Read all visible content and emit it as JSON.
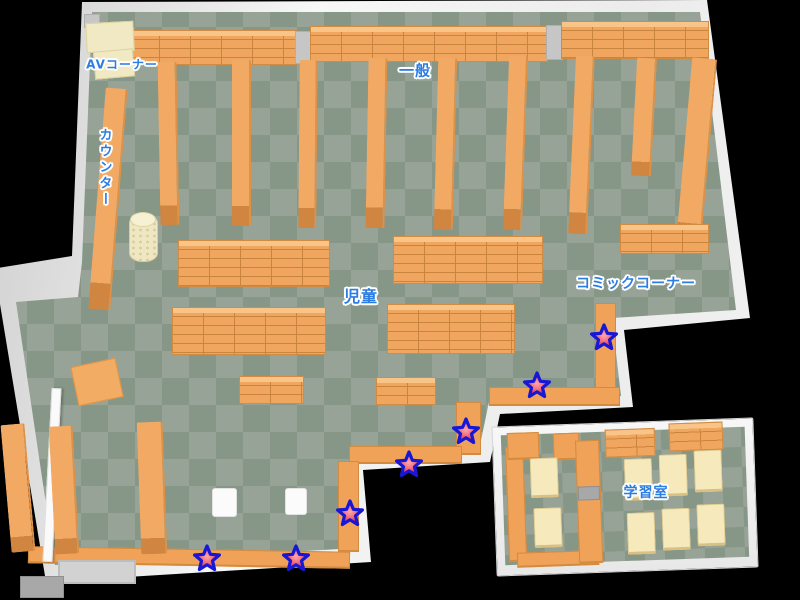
{
  "map": {
    "colors": {
      "background": "#000000",
      "floor_light": "#96a396",
      "floor_dark": "#879787",
      "wall": "#f2f2f2",
      "shelf_orange": "#f0a65f",
      "desk_cream": "#f6e9bb",
      "label_blue": "#2b7de2",
      "star_fill": "#e42f4d",
      "star_center": "#ffa8ac",
      "star_border": "#1717d6"
    },
    "labels": [
      {
        "id": "av-corner",
        "text": "AVコーナー",
        "x": 122,
        "y": 64,
        "size": 12,
        "vertical": false
      },
      {
        "id": "counter",
        "text": "カウンター",
        "x": 104,
        "y": 168,
        "size": 13,
        "vertical": true
      },
      {
        "id": "general",
        "text": "一般",
        "x": 415,
        "y": 70,
        "size": 15,
        "vertical": false
      },
      {
        "id": "children",
        "text": "児童",
        "x": 361,
        "y": 295,
        "size": 16,
        "vertical": false
      },
      {
        "id": "comic-corner",
        "text": "コミックコーナー",
        "x": 636,
        "y": 283,
        "size": 14,
        "vertical": false
      },
      {
        "id": "study-room",
        "text": "学習室",
        "x": 646,
        "y": 492,
        "size": 14,
        "vertical": false
      }
    ],
    "stars": [
      {
        "x": 604,
        "y": 337
      },
      {
        "x": 537,
        "y": 385
      },
      {
        "x": 466,
        "y": 431
      },
      {
        "x": 409,
        "y": 464
      },
      {
        "x": 350,
        "y": 513
      },
      {
        "x": 296,
        "y": 558
      },
      {
        "x": 207,
        "y": 558
      }
    ],
    "furniture": [
      {
        "t": "shelfgrid",
        "x": 128,
        "y": 30,
        "w": 167,
        "h": 33,
        "name": "wall-shelving"
      },
      {
        "t": "pillar",
        "x": 295,
        "y": 31,
        "w": 15,
        "h": 31,
        "name": "pillar"
      },
      {
        "t": "shelfgrid",
        "x": 310,
        "y": 26,
        "w": 236,
        "h": 34,
        "name": "wall-shelving"
      },
      {
        "t": "pillar",
        "x": 546,
        "y": 25,
        "w": 15,
        "h": 33,
        "name": "pillar"
      },
      {
        "t": "shelfgrid",
        "x": 561,
        "y": 21,
        "w": 146,
        "h": 36,
        "name": "wall-shelving"
      },
      {
        "t": "pillar",
        "x": 84,
        "y": 14,
        "w": 14,
        "h": 12,
        "name": "pillar"
      },
      {
        "t": "cream",
        "x": 86,
        "y": 22,
        "w": 46,
        "h": 28,
        "rot": -3,
        "name": "av-table"
      },
      {
        "t": "cream",
        "x": 94,
        "y": 50,
        "w": 38,
        "h": 26,
        "rot": -5,
        "name": "av-table"
      },
      {
        "t": "aisle",
        "x": 97,
        "y": 88,
        "w": 20,
        "h": 222,
        "rot": 4.5,
        "name": "counter-desk"
      },
      {
        "t": "aisle",
        "x": 159,
        "y": 62,
        "w": 17,
        "h": 163,
        "rot": -1,
        "name": "bookshelf-row"
      },
      {
        "t": "aisle",
        "x": 232,
        "y": 60,
        "w": 17,
        "h": 166,
        "rot": 0,
        "name": "bookshelf-row"
      },
      {
        "t": "aisle",
        "x": 299,
        "y": 60,
        "w": 16,
        "h": 168,
        "rot": 0.5,
        "name": "bookshelf-row"
      },
      {
        "t": "aisle",
        "x": 367,
        "y": 58,
        "w": 17,
        "h": 170,
        "rot": 1,
        "name": "bookshelf-row"
      },
      {
        "t": "aisle",
        "x": 436,
        "y": 58,
        "w": 17,
        "h": 172,
        "rot": 1.5,
        "name": "bookshelf-row"
      },
      {
        "t": "aisle",
        "x": 506,
        "y": 56,
        "w": 17,
        "h": 174,
        "rot": 2,
        "name": "bookshelf-row"
      },
      {
        "t": "aisle",
        "x": 572,
        "y": 56,
        "w": 17,
        "h": 178,
        "rot": 2.5,
        "name": "bookshelf-row"
      },
      {
        "t": "aisle",
        "x": 634,
        "y": 58,
        "w": 18,
        "h": 118,
        "rot": 3,
        "name": "bookshelf-row"
      },
      {
        "t": "aisle",
        "x": 684,
        "y": 58,
        "w": 23,
        "h": 188,
        "rot": 5,
        "name": "wall-bookshelf"
      },
      {
        "t": "shelfgrid",
        "x": 620,
        "y": 224,
        "w": 87,
        "h": 28,
        "name": "comic-shelf"
      },
      {
        "t": "shelfgrid",
        "x": 178,
        "y": 240,
        "w": 150,
        "h": 45,
        "name": "kids-shelf-unit"
      },
      {
        "t": "shelfgrid",
        "x": 393,
        "y": 236,
        "w": 148,
        "h": 46,
        "name": "kids-shelf-unit"
      },
      {
        "t": "shelfgrid",
        "x": 172,
        "y": 307,
        "w": 152,
        "h": 46,
        "name": "kids-shelf-unit"
      },
      {
        "t": "shelfgrid",
        "x": 387,
        "y": 304,
        "w": 126,
        "h": 48,
        "name": "kids-shelf-unit"
      },
      {
        "t": "shelfgrid",
        "x": 239,
        "y": 376,
        "w": 63,
        "h": 26,
        "name": "low-shelf"
      },
      {
        "t": "shelfgrid",
        "x": 376,
        "y": 377,
        "w": 58,
        "h": 26,
        "name": "low-shelf"
      },
      {
        "t": "shelf",
        "x": 595,
        "y": 303,
        "w": 19,
        "h": 93,
        "name": "edge-shelf"
      },
      {
        "t": "shelf",
        "x": 489,
        "y": 387,
        "w": 129,
        "h": 16,
        "name": "edge-shelf"
      },
      {
        "t": "shelf",
        "x": 456,
        "y": 402,
        "w": 23,
        "h": 50,
        "name": "edge-shelf"
      },
      {
        "t": "shelf",
        "x": 349,
        "y": 446,
        "w": 111,
        "h": 15,
        "name": "edge-shelf"
      },
      {
        "t": "shelf",
        "x": 338,
        "y": 461,
        "w": 19,
        "h": 88,
        "name": "edge-shelf"
      },
      {
        "t": "shelf",
        "x": 28,
        "y": 549,
        "w": 320,
        "h": 14,
        "rot": 1,
        "name": "edge-shelf"
      },
      {
        "t": "wall",
        "x": 47,
        "y": 388,
        "w": 8,
        "h": 172,
        "rot": 3,
        "name": "partition-wall"
      },
      {
        "t": "aisle",
        "x": 6,
        "y": 424,
        "w": 22,
        "h": 128,
        "rot": -5,
        "name": "bookshelf-row"
      },
      {
        "t": "aisle",
        "x": 52,
        "y": 426,
        "w": 22,
        "h": 128,
        "rot": -3,
        "name": "bookshelf-row"
      },
      {
        "t": "aisle",
        "x": 139,
        "y": 422,
        "w": 24,
        "h": 132,
        "rot": -2,
        "name": "bookshelf-row"
      },
      {
        "t": "square",
        "x": 74,
        "y": 362,
        "w": 44,
        "h": 38,
        "rot": -12,
        "name": "play-mat"
      },
      {
        "t": "cushion",
        "x": 212,
        "y": 488,
        "w": 23,
        "h": 27,
        "name": "cushion"
      },
      {
        "t": "cushion",
        "x": 285,
        "y": 488,
        "w": 20,
        "h": 25,
        "name": "cushion"
      },
      {
        "t": "mat",
        "x": 58,
        "y": 560,
        "w": 74,
        "h": 20,
        "name": "entrance-mat"
      },
      {
        "t": "step",
        "x": 20,
        "y": 576,
        "w": 42,
        "h": 20,
        "name": "entrance-step"
      },
      {
        "t": "shelf",
        "x": 12,
        "y": 20,
        "w": 16,
        "h": 112,
        "parent": "study",
        "name": "study-shelf"
      },
      {
        "t": "shelf",
        "x": 14,
        "y": 6,
        "w": 30,
        "h": 24,
        "parent": "study",
        "name": "study-shelf"
      },
      {
        "t": "shelf",
        "x": 60,
        "y": 8,
        "w": 24,
        "h": 24,
        "parent": "study",
        "name": "study-shelf"
      },
      {
        "t": "shelf",
        "x": 20,
        "y": 126,
        "w": 80,
        "h": 12,
        "parent": "study",
        "name": "study-shelf"
      },
      {
        "t": "shelf",
        "x": 82,
        "y": 16,
        "w": 22,
        "h": 120,
        "parent": "study",
        "name": "study-partition"
      },
      {
        "t": "step",
        "x": 83,
        "y": 62,
        "w": 20,
        "h": 12,
        "parent": "study",
        "name": "study-partition-notch"
      },
      {
        "t": "desk",
        "x": 36,
        "y": 32,
        "w": 26,
        "h": 36,
        "parent": "study",
        "name": "study-desk"
      },
      {
        "t": "desk",
        "x": 38,
        "y": 82,
        "w": 26,
        "h": 36,
        "parent": "study",
        "name": "study-desk"
      },
      {
        "t": "shelfgrid",
        "x": 112,
        "y": 6,
        "w": 48,
        "h": 26,
        "parent": "study",
        "name": "study-shelf"
      },
      {
        "t": "shelfgrid",
        "x": 176,
        "y": 2,
        "w": 52,
        "h": 26,
        "parent": "study",
        "name": "study-shelf"
      },
      {
        "t": "desk",
        "x": 130,
        "y": 36,
        "w": 26,
        "h": 38,
        "parent": "study",
        "name": "study-desk"
      },
      {
        "t": "desk",
        "x": 165,
        "y": 33,
        "w": 26,
        "h": 38,
        "parent": "study",
        "name": "study-desk"
      },
      {
        "t": "desk",
        "x": 200,
        "y": 30,
        "w": 26,
        "h": 38,
        "parent": "study",
        "name": "study-desk"
      },
      {
        "t": "desk",
        "x": 131,
        "y": 90,
        "w": 26,
        "h": 38,
        "parent": "study",
        "name": "study-desk"
      },
      {
        "t": "desk",
        "x": 166,
        "y": 87,
        "w": 26,
        "h": 38,
        "parent": "study",
        "name": "study-desk"
      },
      {
        "t": "desk",
        "x": 201,
        "y": 84,
        "w": 26,
        "h": 38,
        "parent": "study",
        "name": "study-desk"
      }
    ]
  }
}
